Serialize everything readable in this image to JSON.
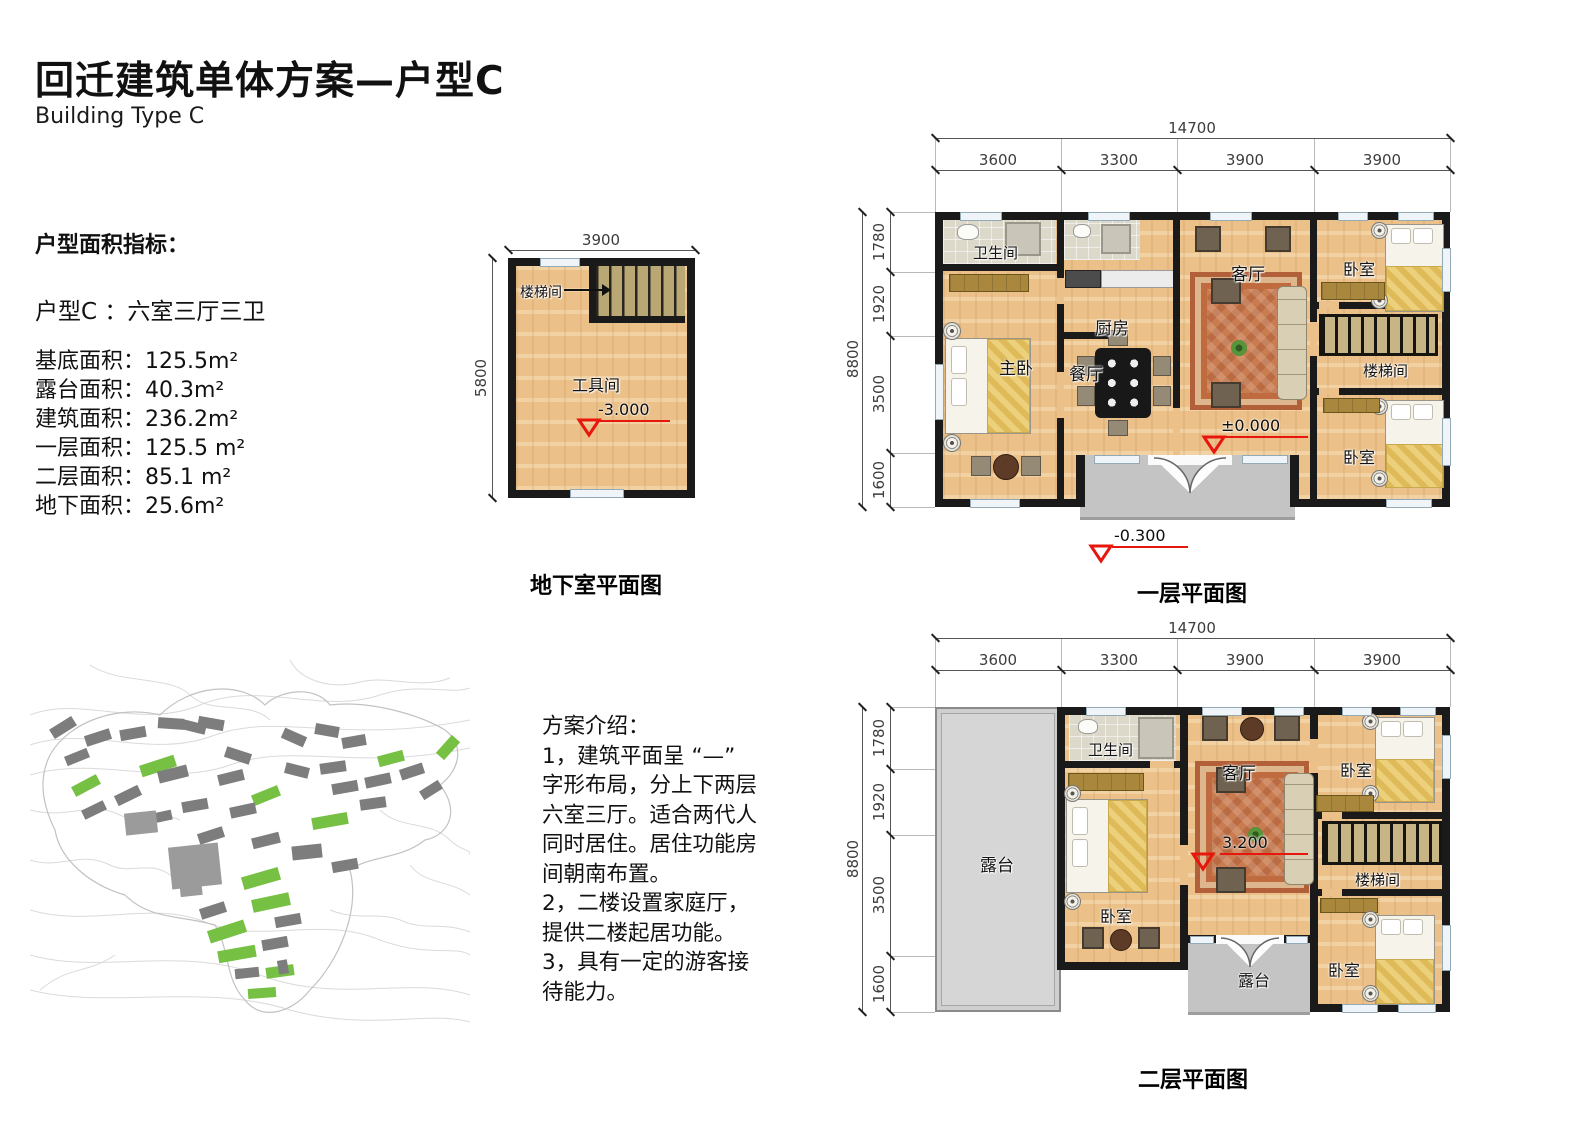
{
  "header": {
    "title": "回迁建筑单体方案—户型C",
    "subtitle": "Building Type C"
  },
  "area_metrics": {
    "heading": "户型面积指标：",
    "type_line": "户型C ：六室三厅三卫",
    "items": [
      {
        "label": "基底面积",
        "value": "125.5m²"
      },
      {
        "label": "露台面积",
        "value": "40.3m²"
      },
      {
        "label": "建筑面积",
        "value": "236.2m²"
      },
      {
        "label": "一层面积",
        "value": "125.5 m²"
      },
      {
        "label": "二层面积",
        "value": "85.1 m²"
      },
      {
        "label": "地下面积",
        "value": "25.6m²"
      }
    ]
  },
  "basement_plan": {
    "caption": "地下室平面图",
    "dim_width": "3900",
    "dim_height": "5800",
    "room_stair": "楼梯间",
    "room_tool": "工具间",
    "level": "-3.000"
  },
  "floor1_plan": {
    "caption": "一层平面图",
    "dim_total_width": "14700",
    "dims_width": [
      "3600",
      "3300",
      "3900",
      "3900"
    ],
    "dim_total_height": "8800",
    "dims_height": [
      "1780",
      "1920",
      "3500",
      "1600"
    ],
    "rooms": {
      "bath": "卫生间",
      "master": "主卧",
      "kitchen": "厨房",
      "dining": "餐厅",
      "living": "客厅",
      "bedroom_ne": "卧室",
      "stair": "楼梯间",
      "bedroom_se": "卧室"
    },
    "level_main": "±0.000",
    "level_entry": "-0.300"
  },
  "floor2_plan": {
    "caption": "二层平面图",
    "dim_total_width": "14700",
    "dims_width": [
      "3600",
      "3300",
      "3900",
      "3900"
    ],
    "dim_total_height": "8800",
    "dims_height": [
      "1780",
      "1920",
      "3500",
      "1600"
    ],
    "rooms": {
      "terrace": "露台",
      "bath": "卫生间",
      "bedroom_w": "卧室",
      "living": "客厅",
      "bedroom_ne": "卧室",
      "stair": "楼梯间",
      "bedroom_se": "卧室",
      "terrace_small": "露台"
    },
    "level_main": "3.200"
  },
  "intro": {
    "heading": "方案介绍：",
    "lines": [
      "1，建筑平面呈 “—”",
      "字形布局，分上下两层",
      "六室三厅。适合两代人",
      "同时居住。居住功能房",
      "间朝南布置。",
      "2，二楼设置家庭厅，",
      "提供二楼起居功能。",
      "3，具有一定的游客接",
      "待能力。"
    ]
  },
  "site_map": {
    "highlight_color": "#76c043",
    "building_color": "#7d7d7d",
    "large_building_color": "#9b9b9b",
    "buildings": [
      {
        "x": 110,
        "y": 100,
        "w": 36,
        "h": 12,
        "r": -18,
        "t": "g"
      },
      {
        "x": 42,
        "y": 120,
        "w": 28,
        "h": 11,
        "r": -28,
        "t": "g"
      },
      {
        "x": 222,
        "y": 130,
        "w": 28,
        "h": 11,
        "r": -22,
        "t": "g"
      },
      {
        "x": 348,
        "y": 93,
        "w": 26,
        "h": 11,
        "r": -15,
        "t": "g"
      },
      {
        "x": 406,
        "y": 82,
        "w": 24,
        "h": 11,
        "r": -48,
        "t": "g"
      },
      {
        "x": 282,
        "y": 155,
        "w": 36,
        "h": 12,
        "r": -10,
        "t": "g"
      },
      {
        "x": 212,
        "y": 212,
        "w": 38,
        "h": 13,
        "r": -16,
        "t": "g"
      },
      {
        "x": 222,
        "y": 236,
        "w": 38,
        "h": 13,
        "r": -12,
        "t": "g"
      },
      {
        "x": 178,
        "y": 265,
        "w": 38,
        "h": 13,
        "r": -18,
        "t": "g"
      },
      {
        "x": 188,
        "y": 288,
        "w": 38,
        "h": 12,
        "r": -10,
        "t": "g"
      },
      {
        "x": 236,
        "y": 306,
        "w": 28,
        "h": 11,
        "r": -8,
        "t": "g"
      },
      {
        "x": 218,
        "y": 328,
        "w": 28,
        "h": 10,
        "r": -4,
        "t": "g"
      },
      {
        "x": 20,
        "y": 62,
        "w": 26,
        "h": 11,
        "r": -32,
        "t": "d"
      },
      {
        "x": 55,
        "y": 72,
        "w": 26,
        "h": 11,
        "r": -18,
        "t": "d"
      },
      {
        "x": 90,
        "y": 68,
        "w": 26,
        "h": 11,
        "r": -10,
        "t": "d"
      },
      {
        "x": 128,
        "y": 58,
        "w": 26,
        "h": 11,
        "r": 4,
        "t": "d"
      },
      {
        "x": 152,
        "y": 62,
        "w": 24,
        "h": 10,
        "r": 14,
        "t": "d"
      },
      {
        "x": 35,
        "y": 92,
        "w": 24,
        "h": 10,
        "r": -22,
        "t": "d"
      },
      {
        "x": 128,
        "y": 108,
        "w": 30,
        "h": 12,
        "r": -14,
        "t": "d"
      },
      {
        "x": 85,
        "y": 130,
        "w": 26,
        "h": 11,
        "r": -26,
        "t": "d"
      },
      {
        "x": 52,
        "y": 145,
        "w": 24,
        "h": 10,
        "r": -26,
        "t": "d"
      },
      {
        "x": 152,
        "y": 140,
        "w": 26,
        "h": 11,
        "r": -10,
        "t": "d"
      },
      {
        "x": 118,
        "y": 152,
        "w": 24,
        "h": 10,
        "r": -12,
        "t": "d"
      },
      {
        "x": 168,
        "y": 170,
        "w": 26,
        "h": 11,
        "r": -18,
        "t": "d"
      },
      {
        "x": 195,
        "y": 90,
        "w": 26,
        "h": 11,
        "r": 18,
        "t": "d"
      },
      {
        "x": 168,
        "y": 58,
        "w": 26,
        "h": 11,
        "r": 10,
        "t": "d"
      },
      {
        "x": 188,
        "y": 112,
        "w": 26,
        "h": 11,
        "r": -14,
        "t": "d"
      },
      {
        "x": 200,
        "y": 145,
        "w": 26,
        "h": 11,
        "r": -12,
        "t": "d"
      },
      {
        "x": 222,
        "y": 175,
        "w": 28,
        "h": 11,
        "r": -14,
        "t": "d"
      },
      {
        "x": 252,
        "y": 72,
        "w": 24,
        "h": 11,
        "r": 24,
        "t": "d"
      },
      {
        "x": 285,
        "y": 65,
        "w": 24,
        "h": 11,
        "r": 10,
        "t": "d"
      },
      {
        "x": 312,
        "y": 76,
        "w": 24,
        "h": 11,
        "r": -10,
        "t": "d"
      },
      {
        "x": 255,
        "y": 105,
        "w": 24,
        "h": 11,
        "r": 14,
        "t": "d"
      },
      {
        "x": 290,
        "y": 102,
        "w": 26,
        "h": 11,
        "r": -8,
        "t": "d"
      },
      {
        "x": 302,
        "y": 122,
        "w": 26,
        "h": 11,
        "r": -10,
        "t": "d"
      },
      {
        "x": 335,
        "y": 115,
        "w": 26,
        "h": 11,
        "r": -12,
        "t": "d"
      },
      {
        "x": 370,
        "y": 106,
        "w": 24,
        "h": 11,
        "r": -18,
        "t": "d"
      },
      {
        "x": 390,
        "y": 125,
        "w": 22,
        "h": 10,
        "r": -32,
        "t": "d"
      },
      {
        "x": 330,
        "y": 138,
        "w": 26,
        "h": 11,
        "r": -8,
        "t": "d"
      },
      {
        "x": 262,
        "y": 185,
        "w": 30,
        "h": 14,
        "r": -6,
        "t": "d"
      },
      {
        "x": 302,
        "y": 200,
        "w": 26,
        "h": 11,
        "r": -10,
        "t": "d"
      },
      {
        "x": 170,
        "y": 245,
        "w": 26,
        "h": 11,
        "r": -18,
        "t": "d"
      },
      {
        "x": 245,
        "y": 255,
        "w": 26,
        "h": 11,
        "r": -10,
        "t": "d"
      },
      {
        "x": 232,
        "y": 278,
        "w": 26,
        "h": 11,
        "r": -10,
        "t": "d"
      },
      {
        "x": 205,
        "y": 308,
        "w": 24,
        "h": 10,
        "r": -6,
        "t": "d"
      },
      {
        "x": 248,
        "y": 300,
        "w": 10,
        "h": 14,
        "r": -10,
        "t": "d"
      },
      {
        "x": 150,
        "y": 188,
        "w": 12,
        "h": 16,
        "r": -20,
        "t": "d"
      },
      {
        "x": 140,
        "y": 185,
        "w": 50,
        "h": 42,
        "r": -6,
        "t": "c"
      },
      {
        "x": 150,
        "y": 222,
        "w": 22,
        "h": 14,
        "r": -6,
        "t": "c"
      },
      {
        "x": 95,
        "y": 152,
        "w": 32,
        "h": 22,
        "r": -6,
        "t": "c"
      }
    ]
  },
  "colors": {
    "accent_green": "#76c043",
    "marker_red": "#e8170d",
    "wall_black": "#1a1a1a",
    "wood_floor": "#ecc189",
    "terrace_gray": "#d6d6d6"
  }
}
